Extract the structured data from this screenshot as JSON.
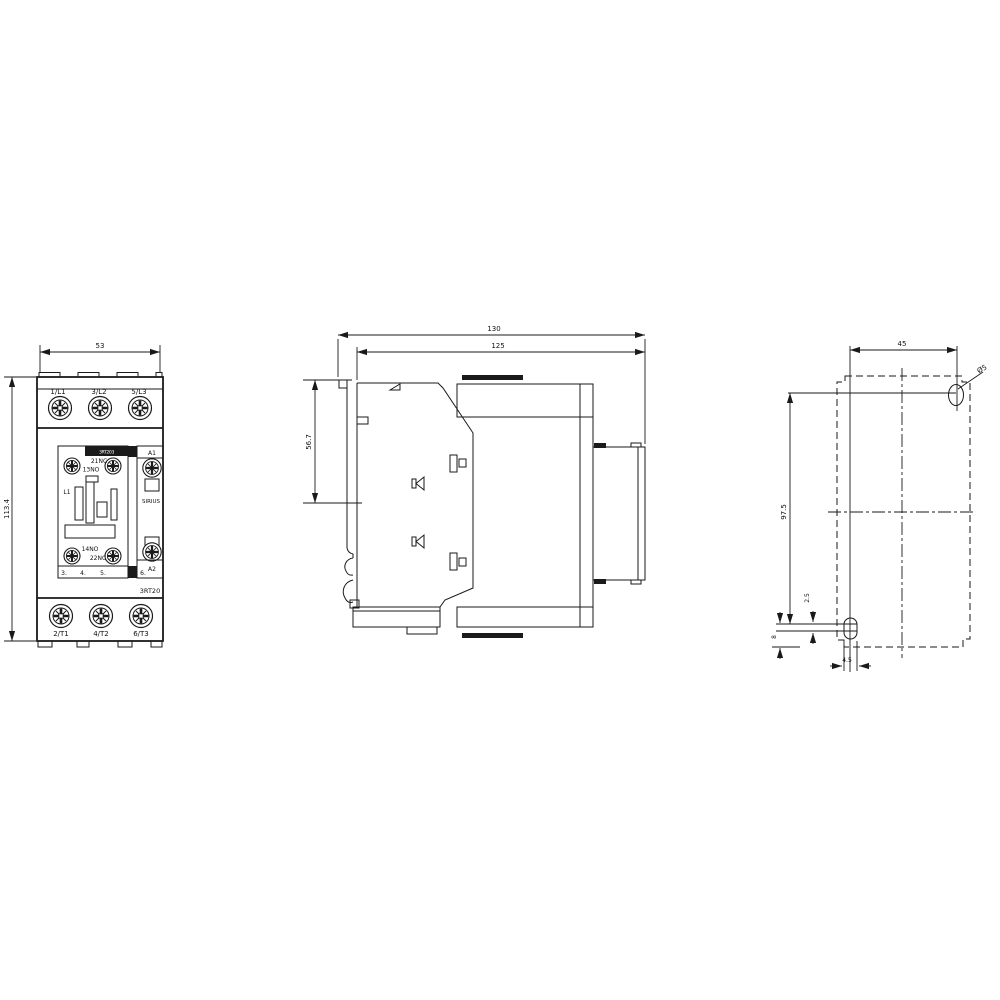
{
  "drawing": {
    "kind": "contactor dimensional drawing",
    "colors": {
      "line": "#1a1a1a",
      "background": "#ffffff"
    }
  },
  "front_view": {
    "dim_width": "53",
    "dim_height": "113.4",
    "terminals_top": [
      "1/L1",
      "3/L2",
      "5/L3"
    ],
    "terminals_bottom": [
      "2/T1",
      "4/T2",
      "6/T3"
    ],
    "aux": {
      "top_nc": "21NC",
      "top_no": "13NO",
      "bottom_no": "14NO",
      "bottom_nc": "22NC"
    },
    "coil": {
      "a1": "A1",
      "a2": "A2"
    },
    "brand": "SIRIUS",
    "type_code": "3RT20",
    "band_text": "3RT203",
    "phase": "L1",
    "row_numbers": [
      "3.",
      "4.",
      "5.",
      "6."
    ]
  },
  "side_view": {
    "dim_overall": "130",
    "dim_body": "125",
    "dim_depth": "56.7"
  },
  "drill_plan": {
    "dim_between_holes_h": "45",
    "dim_between_holes_v": "97.5",
    "dim_bottom_offset": "8",
    "dim_slot_offset": "2.5",
    "dim_slot_width": "4.5",
    "hole_label": "Ø5"
  }
}
